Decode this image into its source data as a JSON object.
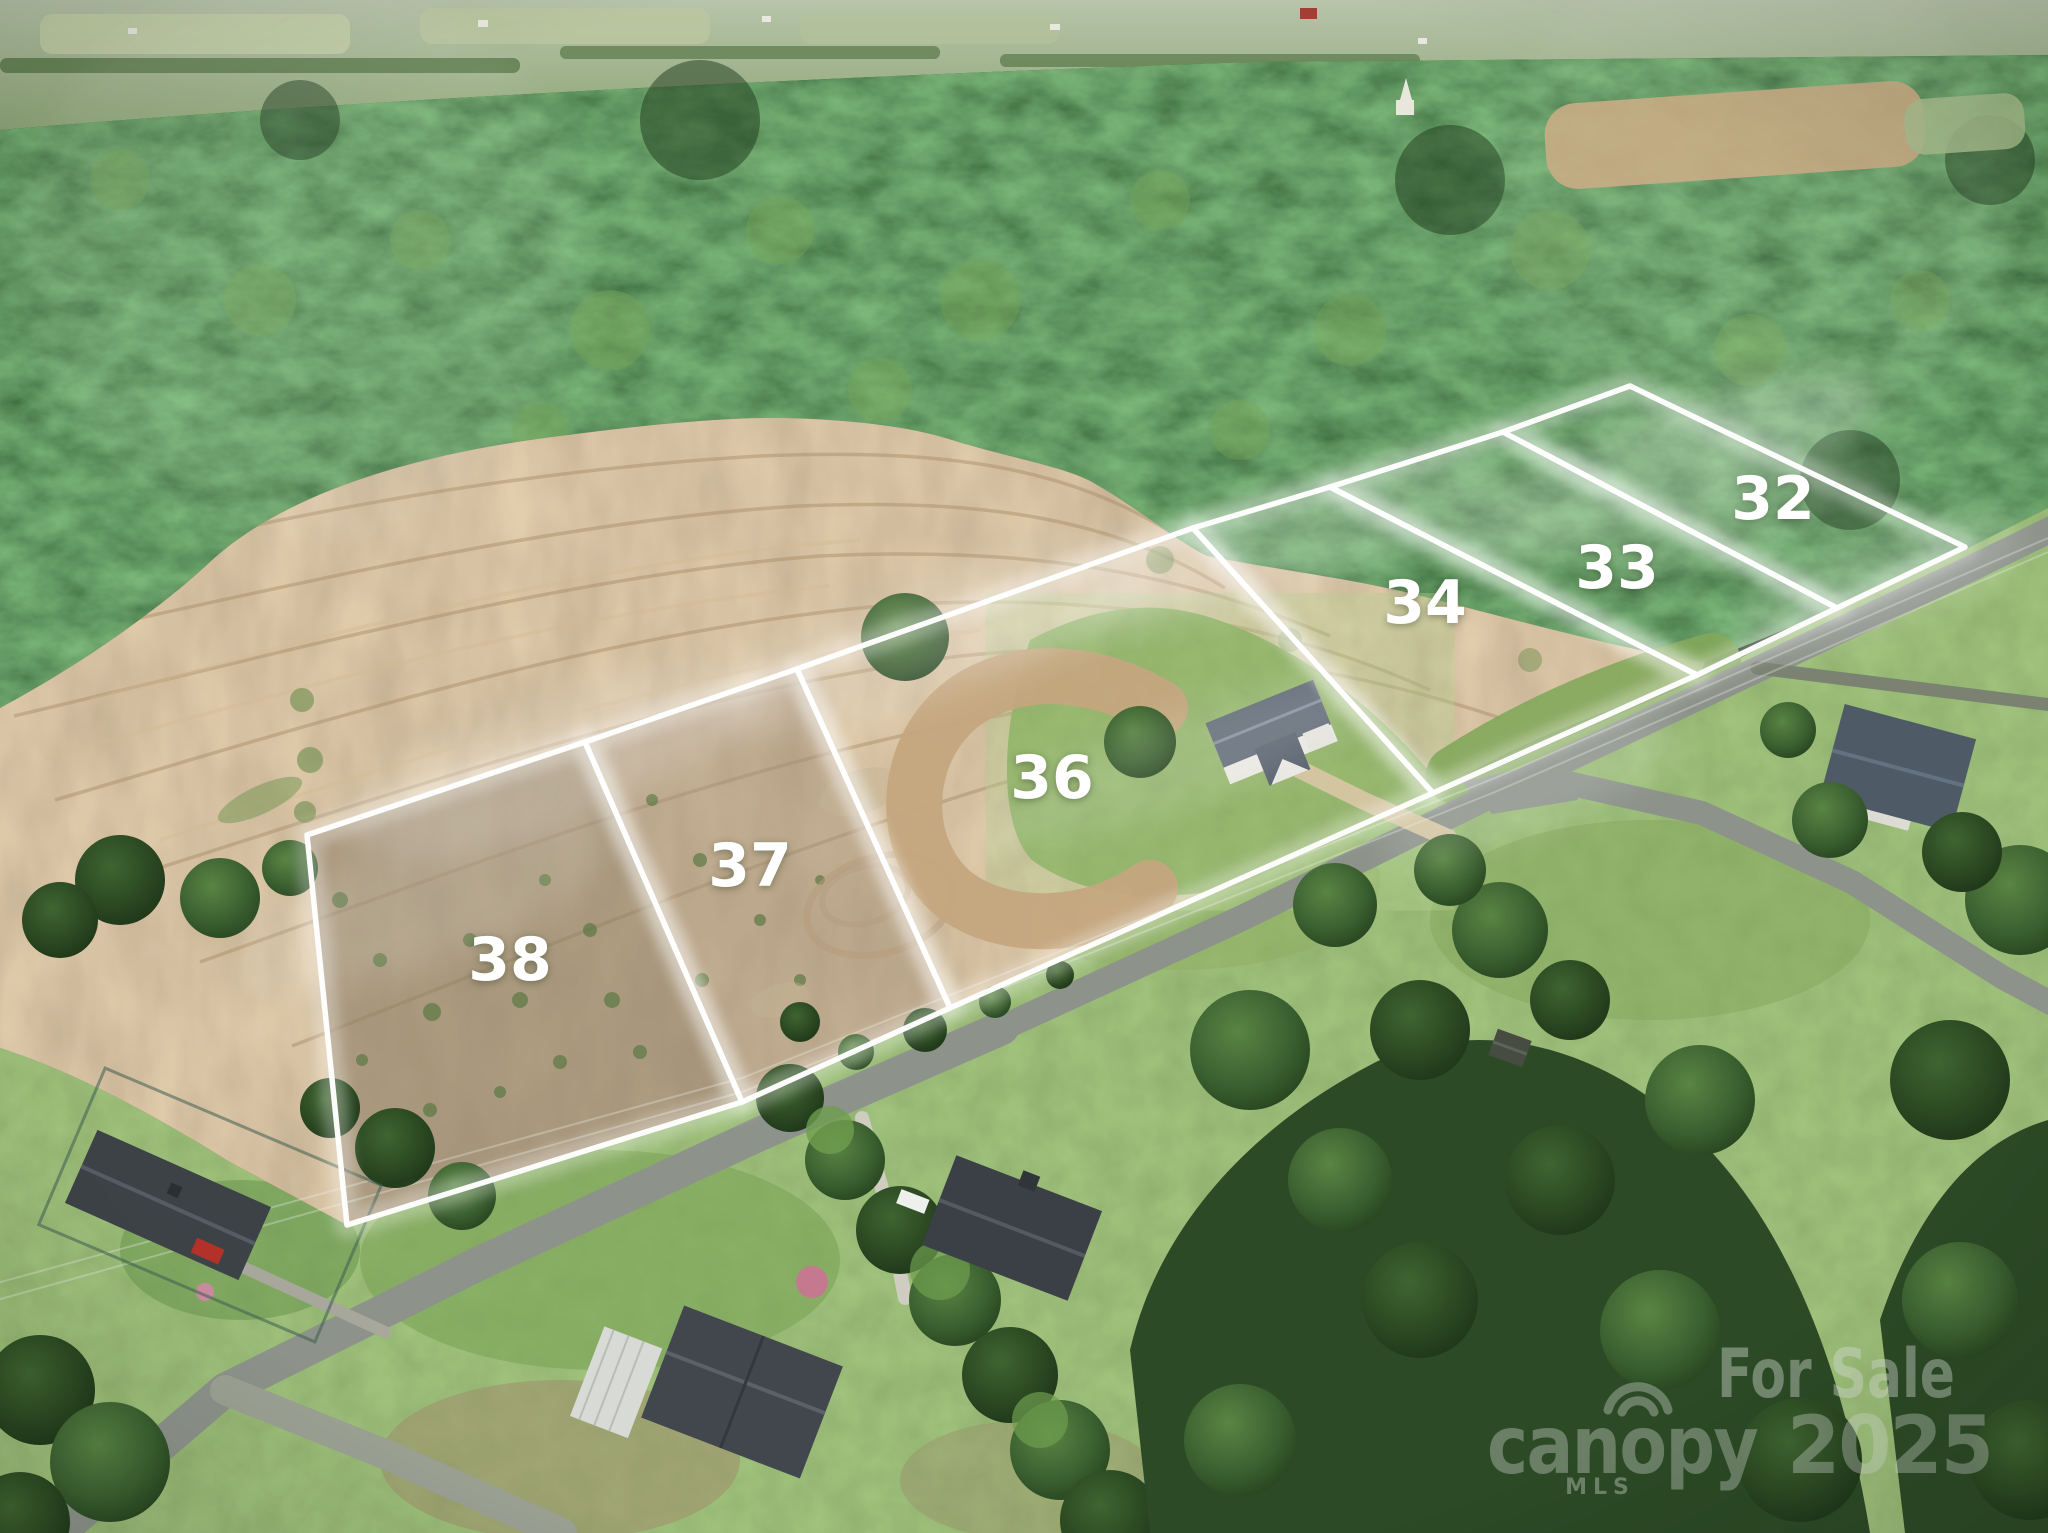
{
  "image": {
    "kind": "aerial-drone-real-estate-photo",
    "description": "Aerial view of rural land subdivision with six outlined lots for sale, plowed tan field, surrounding forest, roads and houses"
  },
  "lots": [
    {
      "number": "38",
      "label": {
        "x": 510,
        "y": 980
      },
      "polygon": [
        [
          307,
          835
        ],
        [
          585,
          742
        ],
        [
          742,
          1102
        ],
        [
          347,
          1225
        ]
      ],
      "ground": "scrub",
      "scrub_fill": "#8e8068",
      "scrub_opacity": 0.62
    },
    {
      "number": "37",
      "label": {
        "x": 750,
        "y": 886
      },
      "polygon": [
        [
          585,
          742
        ],
        [
          797,
          669
        ],
        [
          950,
          1008
        ],
        [
          742,
          1102
        ]
      ],
      "ground": "scrub",
      "scrub_fill": "#a39077",
      "scrub_opacity": 0.5
    },
    {
      "number": "36",
      "label": {
        "x": 1052,
        "y": 798
      },
      "polygon": [
        [
          797,
          669
        ],
        [
          1193,
          528
        ],
        [
          1433,
          793
        ],
        [
          950,
          1008
        ]
      ],
      "ground": "field-lawn"
    },
    {
      "number": "34",
      "label": {
        "x": 1425,
        "y": 623
      },
      "polygon": [
        [
          1193,
          528
        ],
        [
          1330,
          487
        ],
        [
          1697,
          675
        ],
        [
          1433,
          793
        ]
      ],
      "ground": "field"
    },
    {
      "number": "33",
      "label": {
        "x": 1617,
        "y": 588
      },
      "polygon": [
        [
          1330,
          487
        ],
        [
          1503,
          432
        ],
        [
          1837,
          608
        ],
        [
          1697,
          675
        ]
      ],
      "ground": "field-forest"
    },
    {
      "number": "32",
      "label": {
        "x": 1773,
        "y": 519
      },
      "polygon": [
        [
          1503,
          432
        ],
        [
          1630,
          386
        ],
        [
          1965,
          547
        ],
        [
          1837,
          608
        ]
      ],
      "ground": "forest"
    }
  ],
  "watermarks": {
    "for_sale": "For Sale",
    "brand": "canopy",
    "year": "2025",
    "mls": "MLS"
  },
  "colors": {
    "boundary_line": "#ffffff",
    "lot_number_text": "#ffffff",
    "watermark_text": "#d9ded7",
    "forest_dark": "#2c4a26",
    "forest_light": "#6f9b53",
    "field_tan": "#bb9e78",
    "lawn_green": "#7aa155",
    "road_asphalt": "#8d928b"
  }
}
